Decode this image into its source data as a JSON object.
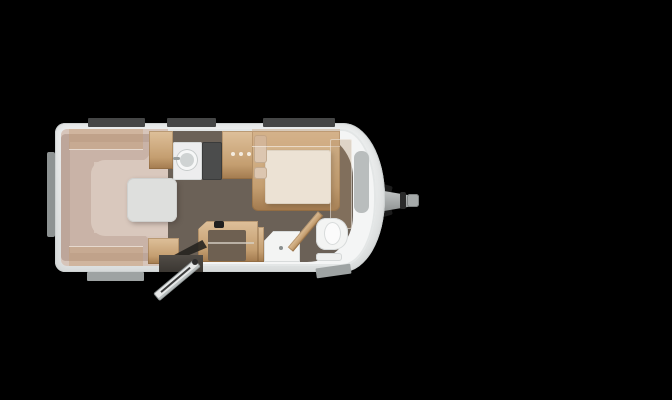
{
  "colors": {
    "bg": "#000000",
    "bodyFill": "#e9ebeb",
    "bodyEdge": "#cdd1d1",
    "wallInner": "#f4f5f5",
    "floor": "#6b6157",
    "seat": "#c9b3a7",
    "seatBack": "#bda69a",
    "seatBase": "#d7c5ba",
    "seatInner": "#d9c8bd",
    "table": "#dedfdd",
    "wood": "#c49e70",
    "woodDark": "#a27a4e",
    "woodLight": "#dec09a",
    "woodTint": "rgba(196,156,112,0.38)",
    "counter": "#ededee",
    "hob": "#4b4c4c",
    "sink": "#cfd3d3",
    "mattress": "#ece2d4",
    "pillow": "#dcc6b0",
    "grayPanel": "#b9bdbd",
    "winDark": "#454646",
    "winLight": "#9ea3a3",
    "fixture": "#f3f4f3",
    "fixtureEdge": "#d8dbdb",
    "hitchDark": "#1c1c1c",
    "doorLeaf": "#e6e8e8",
    "doorway": "#514c46",
    "swing": "#26231f",
    "kneehole": "#6e6051"
  },
  "floorplan": {
    "type": "caravan-top-view",
    "orientation": "hitch-right",
    "rooms": [
      {
        "name": "lounge-dinette",
        "features": [
          "u-shaped-seating",
          "dining-table",
          "overhead-lockers"
        ]
      },
      {
        "name": "kitchen",
        "features": [
          "round-sink",
          "hob",
          "wood-cabinet-with-knobs"
        ]
      },
      {
        "name": "bedroom",
        "features": [
          "french-bed",
          "pillows",
          "wardrobe",
          "front-storage-panel"
        ]
      },
      {
        "name": "bathroom",
        "features": [
          "shower-tray",
          "toilet",
          "washbasin-shelf",
          "angled-partition"
        ]
      },
      {
        "name": "entrance",
        "features": [
          "open-door",
          "desk-cabinet"
        ]
      }
    ],
    "windows": {
      "top": 3,
      "bottom": 2,
      "rear": 1
    },
    "door": {
      "state": "open",
      "position": "bottom"
    },
    "hitch": {
      "position": "right",
      "parts": [
        "drawbar",
        "coupling-band",
        "coupling-tip",
        "clamps"
      ]
    }
  }
}
